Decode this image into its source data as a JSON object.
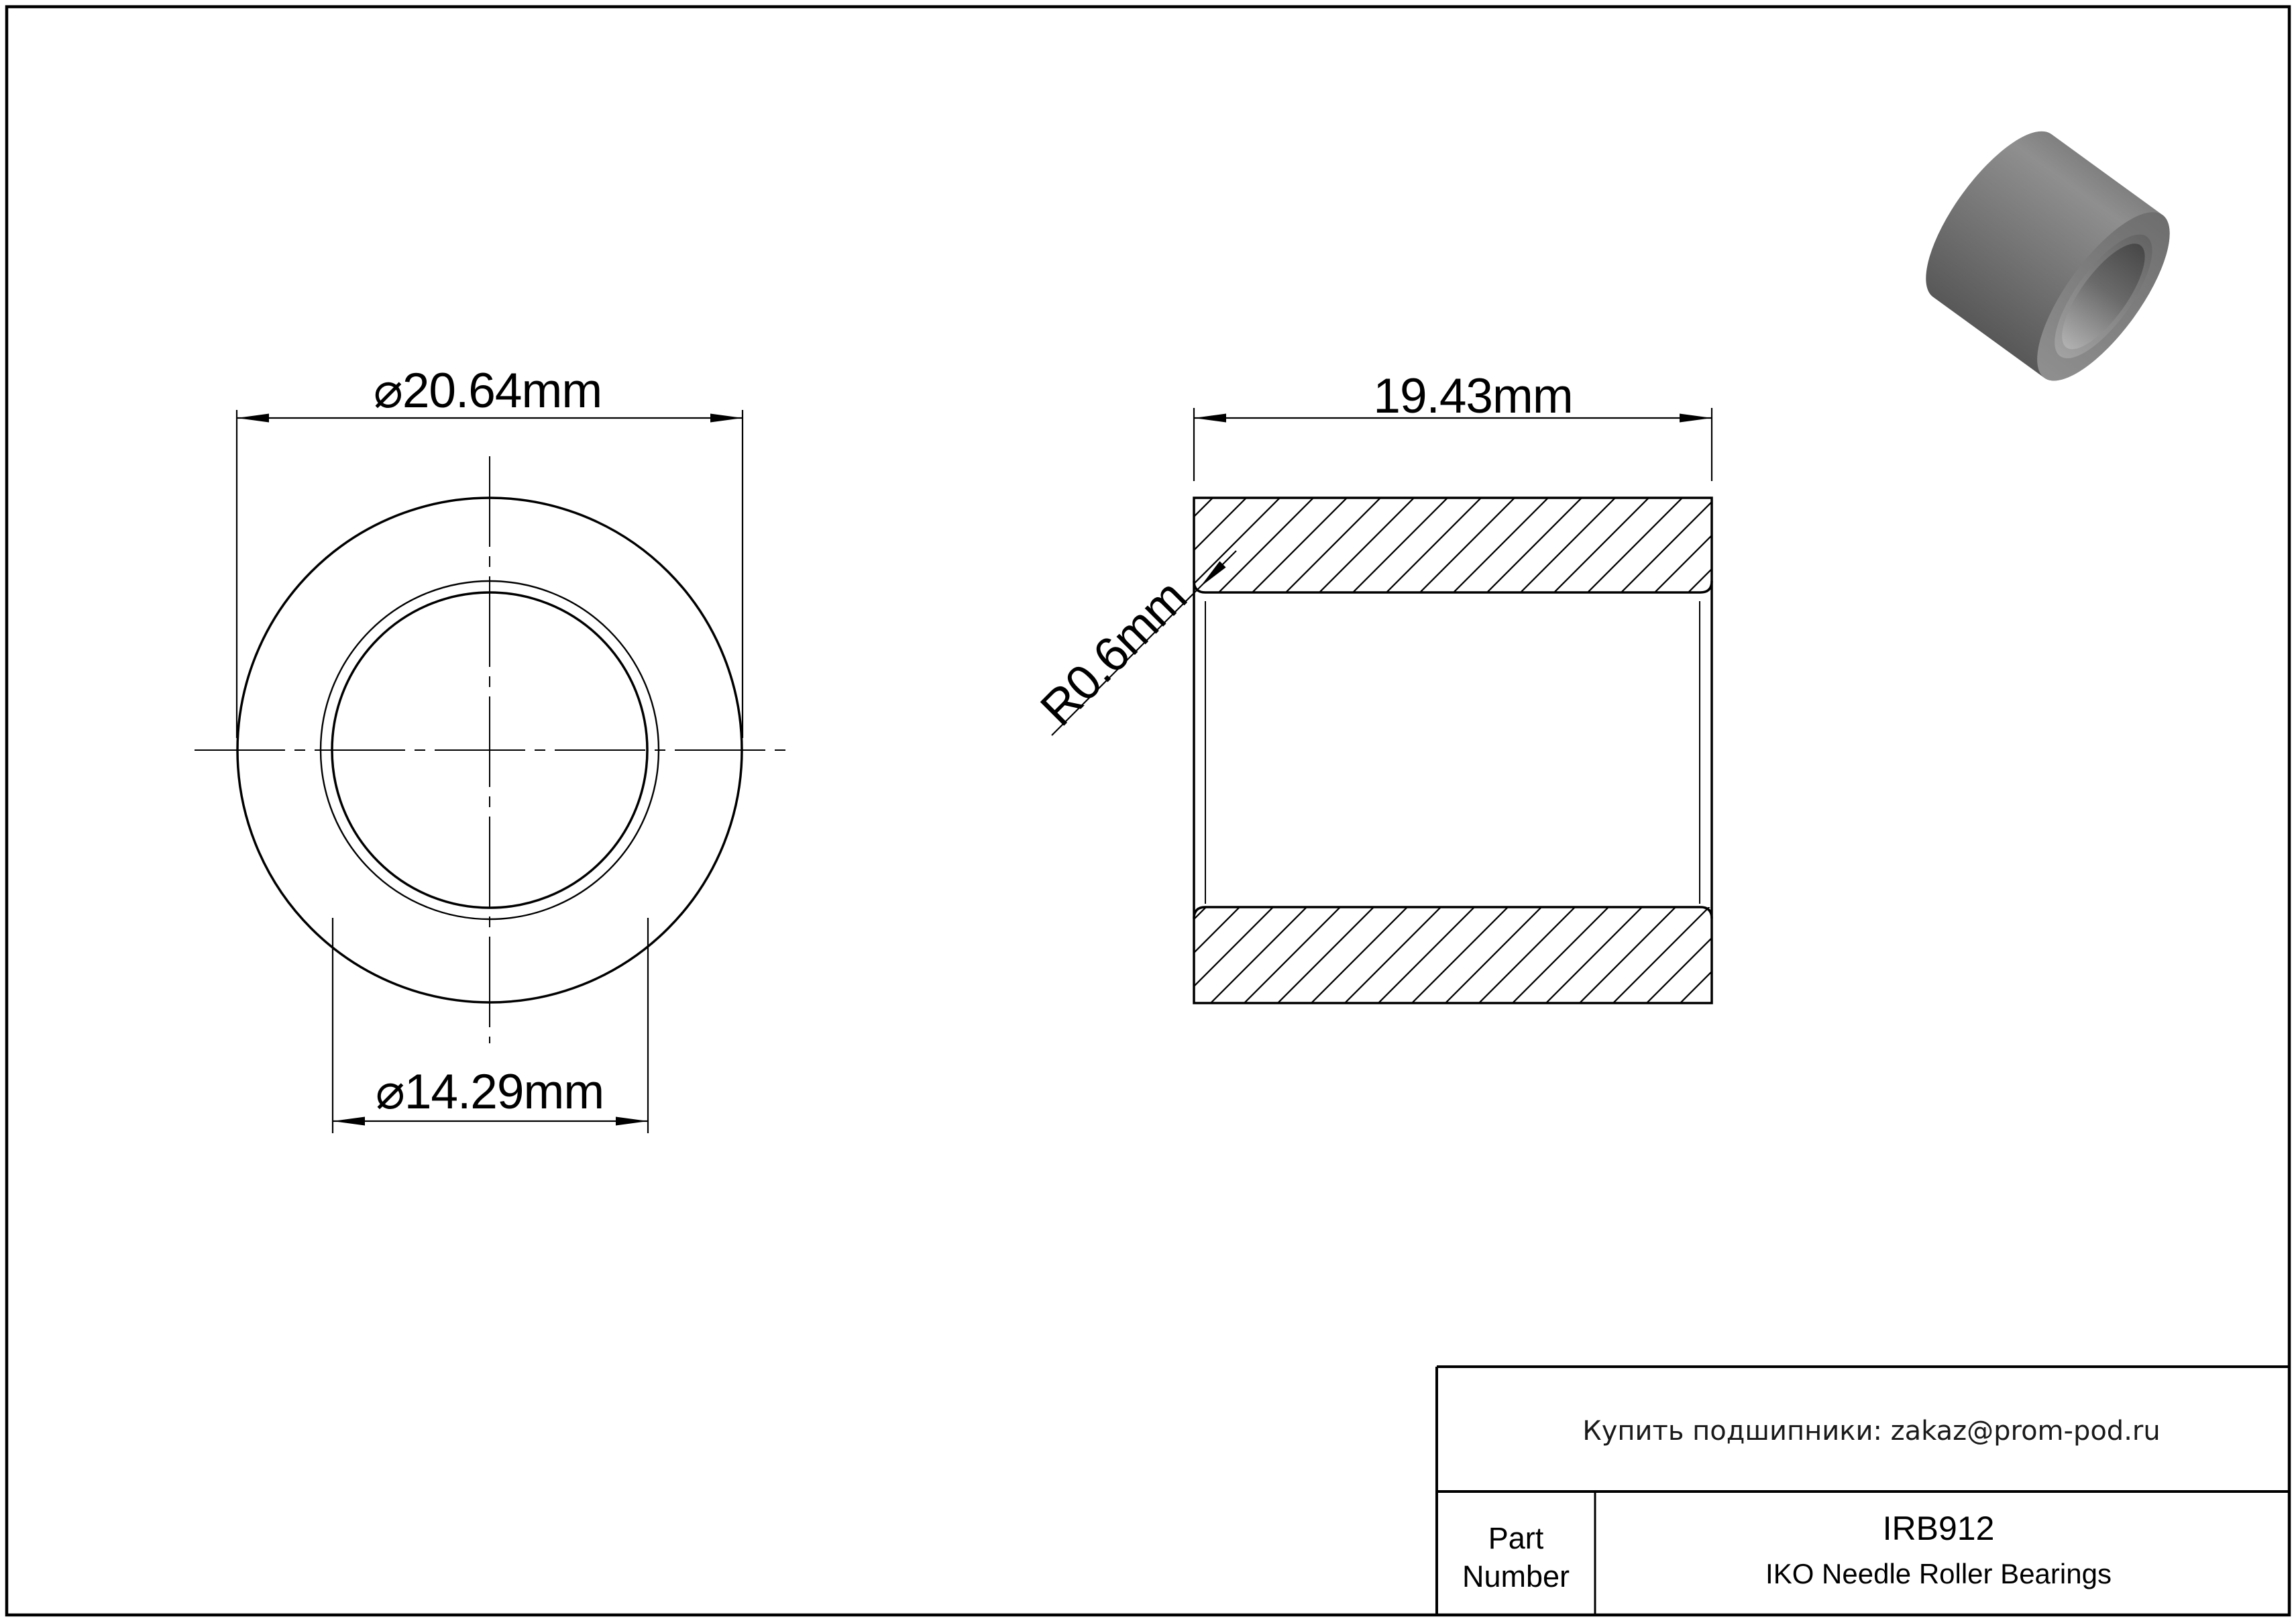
{
  "page": {
    "background": "#ffffff",
    "line_color": "#000000"
  },
  "front_view": {
    "outer_diameter_label": "⌀20.64mm",
    "bore_diameter_label": "⌀14.29mm"
  },
  "section_view": {
    "width_label": "19.43mm",
    "corner_radius_label": "R0.6mm"
  },
  "title_block": {
    "contact_text": "Купить подшипники: zakaz@prom-pod.ru",
    "part_label_line1": "Part",
    "part_label_line2": "Number",
    "part_number": "IRB912",
    "product_line": "IKO Needle Roller Bearings"
  },
  "render_3d": {
    "body_top": "#7e7e7e",
    "body_highlight": "#8f8f8f",
    "body_mid": "#757575",
    "body_bottom": "#575757",
    "face_top": "#6e6e6e",
    "face_bottom": "#8f8f8f",
    "chamfer_top": "#646464",
    "chamfer_bottom": "#a2a2a2",
    "bore_top": "#474747",
    "bore_mid": "#6a6a6a",
    "bore_bottom": "#b2b2b2"
  }
}
